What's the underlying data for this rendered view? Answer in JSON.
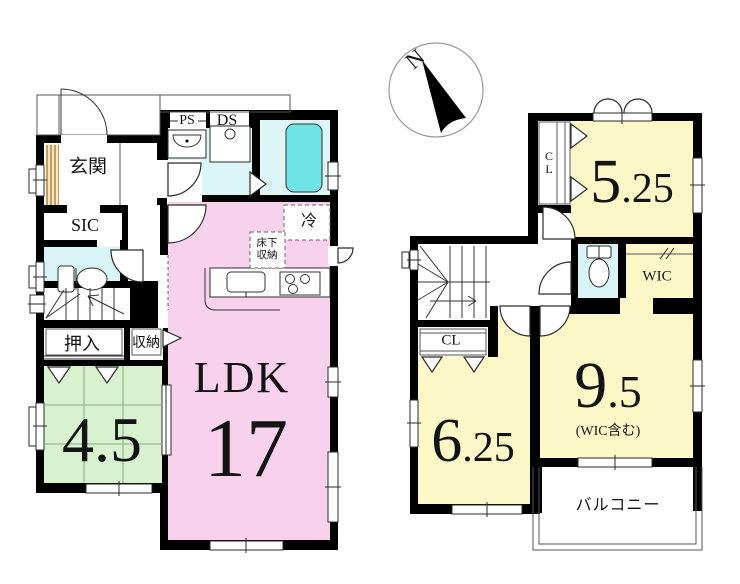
{
  "compass": {
    "north": "N"
  },
  "floor1": {
    "entrance": "玄関",
    "shoe_in_closet": "SIC",
    "pipe_space": "PS",
    "duct_space": "DS",
    "fridge": "冷",
    "underfloor1": "床下",
    "underfloor2": "収納",
    "closet_oshiire": "押入",
    "storage": "収納",
    "tatami_size": "4.5",
    "ldk": "LDK",
    "ldk_size": "17"
  },
  "floor2": {
    "closet_a": "CL",
    "room_a_int": "5",
    "room_a_frac": ".25",
    "wic": "WIC",
    "closet_b": "CL",
    "room_b_int": "6",
    "room_b_frac": ".25",
    "room_c_int": "9",
    "room_c_frac": ".5",
    "room_c_note": "(WIC含む)",
    "balcony": "バルコニー"
  }
}
